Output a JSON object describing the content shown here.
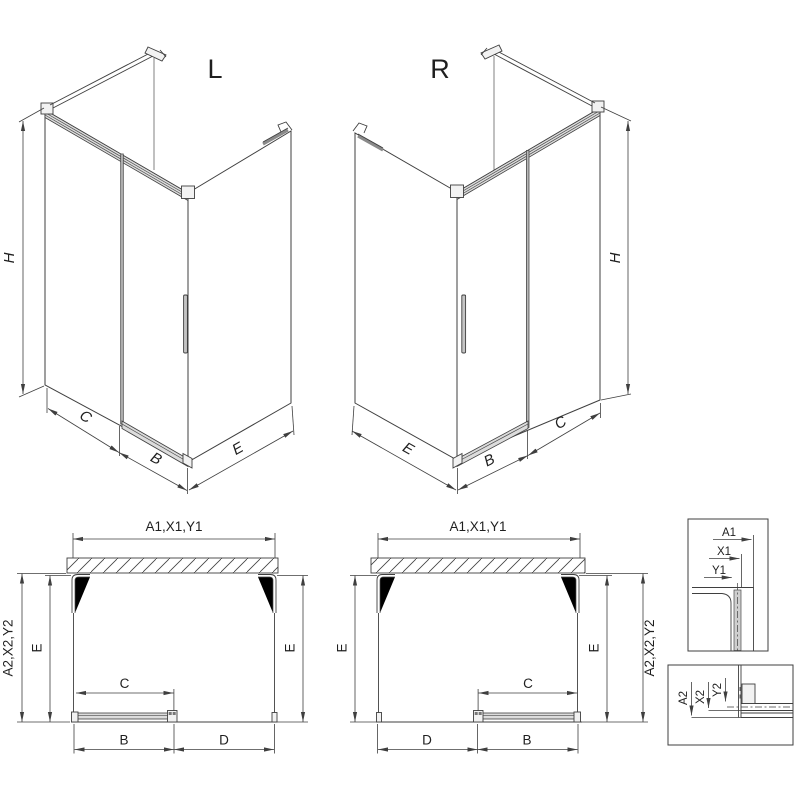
{
  "drawing": {
    "iso_left": {
      "title": "L",
      "dim_height": "H",
      "dim_c": "C",
      "dim_b": "B",
      "dim_e": "E"
    },
    "iso_right": {
      "title": "R",
      "dim_height": "H",
      "dim_c": "C",
      "dim_b": "B",
      "dim_e": "E"
    },
    "plan_left": {
      "dim_width_top": "A1,X1,Y1",
      "dim_depth_outer": "A2,X2,Y2",
      "dim_depth_left": "E",
      "dim_depth_right": "E",
      "dim_c": "C",
      "dim_b": "B",
      "dim_d": "D"
    },
    "plan_right": {
      "dim_width_top": "A1,X1,Y1",
      "dim_depth_outer": "A2,X2,Y2",
      "dim_depth_left": "E",
      "dim_depth_right": "E",
      "dim_c": "C",
      "dim_b": "B",
      "dim_d": "D"
    },
    "detail_top_profile": {
      "dim_a1": "A1",
      "dim_x1": "X1",
      "dim_y1": "Y1"
    },
    "detail_bottom_profile": {
      "dim_a2": "A2",
      "dim_x2": "X2",
      "dim_y2": "Y2"
    },
    "colors": {
      "line": "#3f3f3f",
      "metal_fill": "#dcdcdc",
      "door_edge_gray": "#b8b8b8",
      "background": "#ffffff"
    }
  }
}
